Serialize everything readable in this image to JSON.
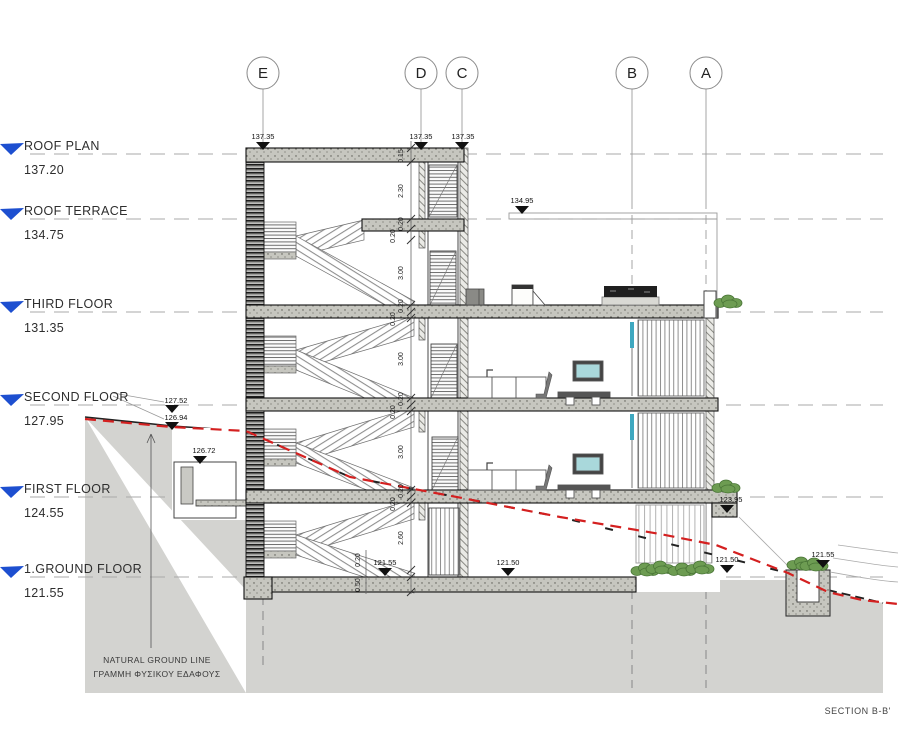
{
  "title": {
    "section_label": "SECTION B-B'"
  },
  "grid_bubbles": [
    "E",
    "D",
    "C",
    "B",
    "A"
  ],
  "levels": [
    {
      "name": "ROOF PLAN",
      "elevation": "137.20"
    },
    {
      "name": "ROOF TERRACE",
      "elevation": "134.75"
    },
    {
      "name": "THIRD FLOOR",
      "elevation": "131.35"
    },
    {
      "name": "SECOND FLOOR",
      "elevation": "127.95"
    },
    {
      "name": "FIRST FLOOR",
      "elevation": "124.55"
    },
    {
      "name": "1.GROUND FLOOR",
      "elevation": "121.55"
    }
  ],
  "spot_elevations": {
    "parapet_e": "137.35",
    "parapet_d": "137.35",
    "parapet_c": "137.35",
    "terrace_railing": "134.95",
    "retaining_wall_top": "127.52",
    "retaining_wall_base": "126.94",
    "lightwell_top": "126.72",
    "balcony_step": "123.95",
    "ground_slab_left": "121.55",
    "ground_slab_mid": "121.50",
    "garden_right": "121.50",
    "planter_right": "121.55"
  },
  "dim_chain": [
    "0.15",
    "2.30",
    "0.20",
    "0.20",
    "3.00",
    "0.20",
    "0.20",
    "3.00",
    "0.20",
    "0.20",
    "3.00",
    "0.20",
    "0.20",
    "2.60"
  ],
  "dim_footing": [
    "0.20",
    "0.50"
  ],
  "notes": {
    "ground_line_en": "NATURAL GROUND LINE",
    "ground_line_el": "ΓΡΑΜΜΗ ΦΥΣΙΚΟΥ ΕΔΑΦΟΥΣ"
  },
  "colors": {
    "level_marker_blue": "#1d4fd0",
    "natural_ground_red": "#d42020",
    "terrain": "#d3d3d0",
    "plants": "#6d9c52",
    "glass": "#a9d8db"
  }
}
